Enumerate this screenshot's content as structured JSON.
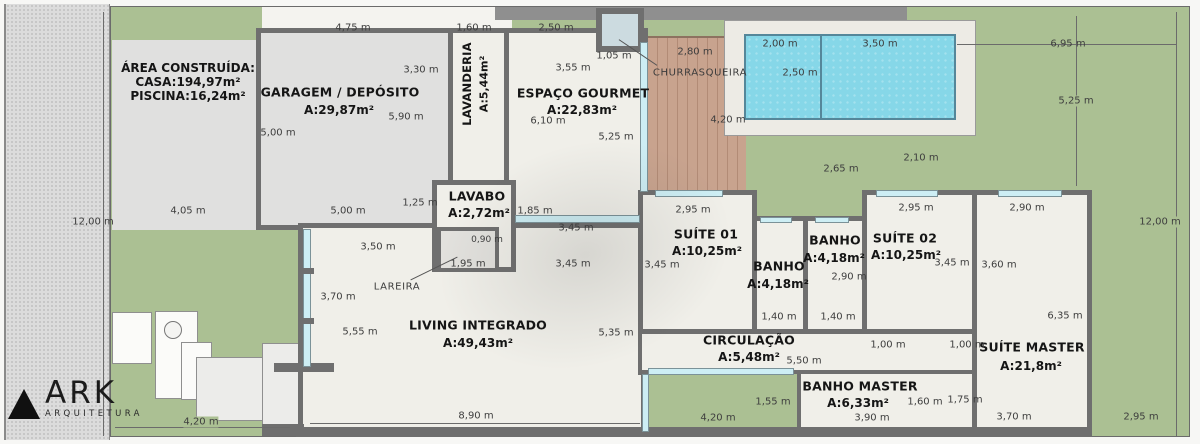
{
  "branding": {
    "logo": "ARK",
    "tagline": "ARQUITETURA"
  },
  "plan": {
    "area_summary": {
      "title": "ÁREA CONSTRUÍDA:",
      "casa": "CASA:194,97m²",
      "piscina": "PISCINA:16,24m²"
    },
    "rooms": {
      "garagem": {
        "name": "GARAGEM / DEPÓSITO",
        "area": "A:29,87m²"
      },
      "lavanderia": {
        "name": "LAVANDERIA",
        "area": "A:5,44m²"
      },
      "gourmet": {
        "name": "ESPAÇO GOURMET",
        "area": "A:22,83m²"
      },
      "lavabo": {
        "name": "LAVABO",
        "area": "A:2,72m²"
      },
      "living": {
        "name": "LIVING INTEGRADO",
        "area": "A:49,43m²"
      },
      "suite01": {
        "name": "SUÍTE 01",
        "area": "A:10,25m²"
      },
      "banho1": {
        "name": "BANHO",
        "area": "A:4,18m²"
      },
      "banho2": {
        "name": "BANHO",
        "area": "A:4,18m²"
      },
      "suite02": {
        "name": "SUÍTE 02",
        "area": "A:10,25m²"
      },
      "suite_master": {
        "name": "SUÍTE MASTER",
        "area": "A:21,8m²"
      },
      "circulacao": {
        "name": "CIRCULAÇÃO",
        "area": "A:5,48m²"
      },
      "banho_master": {
        "name": "BANHO MASTER",
        "area": "A:6,33m²"
      }
    },
    "annotations": {
      "churrasqueira": "CHURRASQUEIRA",
      "lareira": "LAREIRA"
    },
    "dims": [
      "4,75 m",
      "1,60 m",
      "2,50 m",
      "1,05 m",
      "2,80 m",
      "2,00 m",
      "3,50 m",
      "6,95 m",
      "3,30 m",
      "5,90 m",
      "5,00 m",
      "3,55 m",
      "6,10 m",
      "5,25 m",
      "2,50 m",
      "4,20 m",
      "5,25 m",
      "2,65 m",
      "2,10 m",
      "12,00 m",
      "12,00 m",
      "4,05 m",
      "5,00 m",
      "1,25 m",
      "1,85 m",
      "3,45 m",
      "0,90 m",
      "1,95 m",
      "3,45 m",
      "3,50 m",
      "3,70 m",
      "5,55 m",
      "5,35 m",
      "8,90 m",
      "2,95 m",
      "3,45 m",
      "2,90 m",
      "1,40 m",
      "1,40 m",
      "2,95 m",
      "3,45 m",
      "2,90 m",
      "3,60 m",
      "6,35 m",
      "1,00 m",
      "1,00 m",
      "5,50 m",
      "1,55 m",
      "4,20 m",
      "3,90 m",
      "1,60 m",
      "1,75 m",
      "3,70 m",
      "2,95 m",
      "4,20 m"
    ],
    "colors": {
      "grass": "#abc093",
      "pool": "#86d7e8",
      "deck": "#c8a38e",
      "wall": "#6f6f6f",
      "floor": "#f0efe9",
      "paving": "#e0e0df",
      "window": "#cdeef4"
    }
  }
}
